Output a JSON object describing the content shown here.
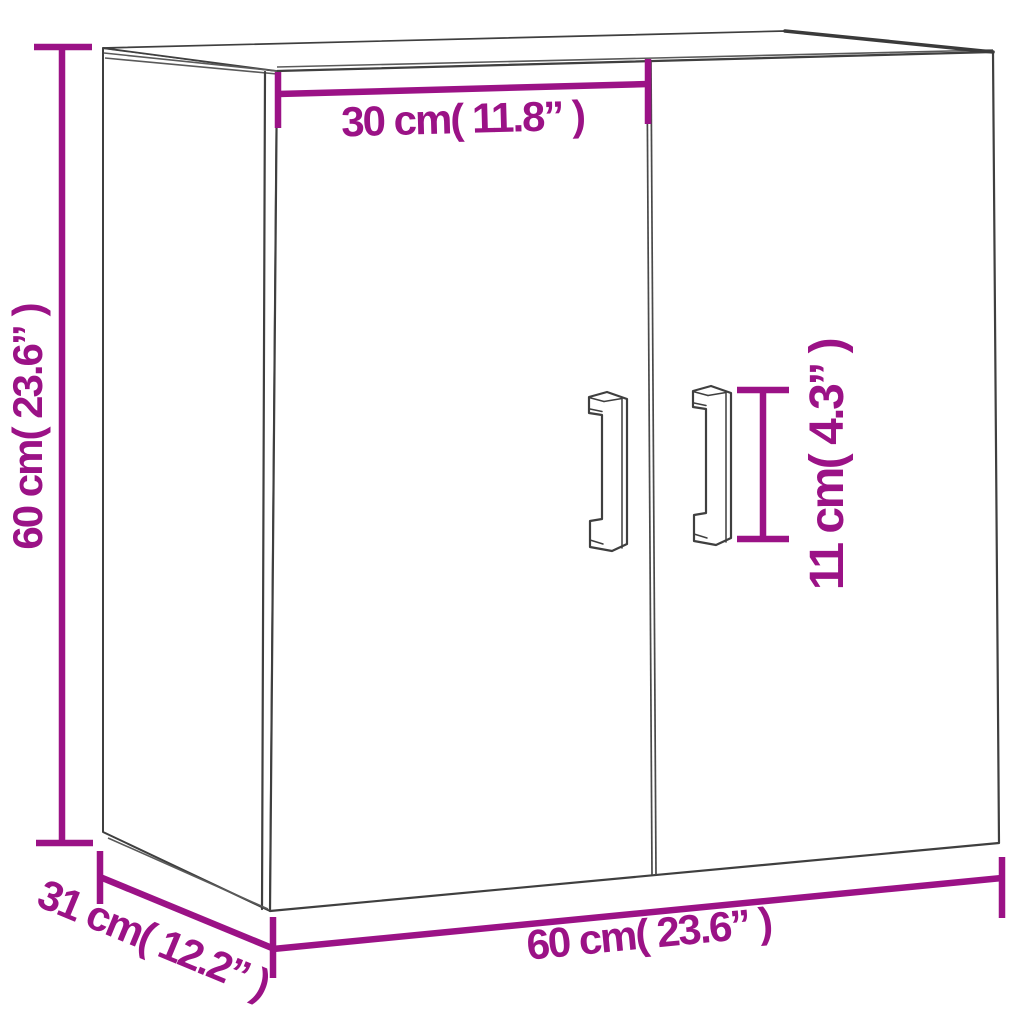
{
  "diagram": {
    "title": "Wall cabinet dimension diagram",
    "background": "#FFFFFF",
    "colors": {
      "dimension": "#9B1286",
      "outline": "#3F3F3F"
    },
    "measurements": [
      {
        "name": "height",
        "cm": 60,
        "inches": 23.6,
        "label": "60 cm( 23.6” )"
      },
      {
        "name": "door_width",
        "cm": 30,
        "inches": 11.8,
        "label": "30 cm( 11.8” )"
      },
      {
        "name": "handle_height",
        "cm": 11,
        "inches": 4.3,
        "label": "11 cm( 4.3” )"
      },
      {
        "name": "width",
        "cm": 60,
        "inches": 23.6,
        "label": "60 cm( 23.6” )"
      },
      {
        "name": "depth",
        "cm": 31,
        "inches": 12.2,
        "label": "31 cm( 12.2” )"
      }
    ],
    "labels": {
      "height": "60 cm( 23.6” )",
      "door_width": "30 cm( 11.8” )",
      "handle_height": "11 cm( 4.3” )",
      "width": "60 cm( 23.6” )",
      "depth": "31 cm( 12.2” )"
    }
  }
}
